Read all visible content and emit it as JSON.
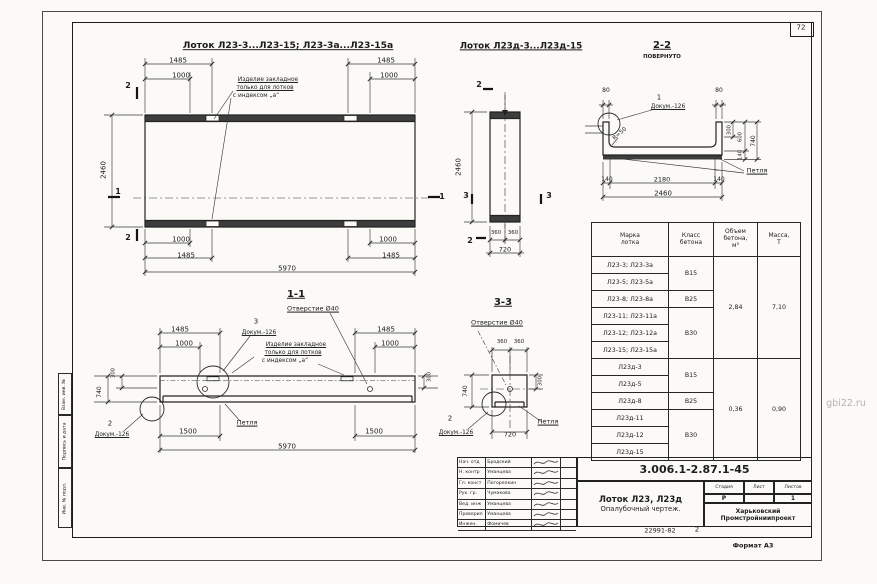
{
  "page": {
    "number": "72",
    "watermark": "gbi22.ru",
    "format": "Формат А3",
    "doc_code": "22991-82",
    "doc_code_extra": "2"
  },
  "side_stamps": [
    "Взам. инв. №",
    "Подпись и дата",
    "Инв. № подл."
  ],
  "title_block": {
    "code": "3.006.1-2.87.1-45",
    "product": "Лоток Л23, Л23д",
    "doc_type": "Опалубочный чертеж.",
    "stage_label": "Стадия",
    "sheet_label": "Лист",
    "sheets_label": "Листов",
    "stage": "Р",
    "sheet": "",
    "sheets": "1",
    "org_line1": "Харьковский",
    "org_line2": "Промстройниипроект"
  },
  "signatures": [
    {
      "role": "Нач. отд",
      "name": "Бродский"
    },
    {
      "role": "Н. контр",
      "name": "Уманцева"
    },
    {
      "role": "Гл. конст",
      "name": "Погорелкин"
    },
    {
      "role": "Рук. гр.",
      "name": "Чумакова"
    },
    {
      "role": "Вед. инж",
      "name": "Уманцева"
    },
    {
      "role": "Проверил",
      "name": "Уманцева"
    },
    {
      "role": "Инжен.",
      "name": "Фомичев"
    }
  ],
  "table": {
    "headers": [
      "Марка\nлотка",
      "Класс\nбетона",
      "Объем\nбетона,\nм³",
      "Масса,\nТ"
    ],
    "rows": [
      {
        "mark": "Л23-3; Л23-3а",
        "cls": "В15",
        "cls_span": 2,
        "vol": "2,84",
        "vol_span": 6,
        "mass": "7,10",
        "mass_span": 6
      },
      {
        "mark": "Л23-5; Л23-5а"
      },
      {
        "mark": "Л23-8; Л23-8а",
        "cls": "В25",
        "cls_span": 1
      },
      {
        "mark": "Л23-11; Л23-11а",
        "cls": "В30",
        "cls_span": 3
      },
      {
        "mark": "Л23-12; Л23-12а"
      },
      {
        "mark": "Л23-15; Л23-15а"
      },
      {
        "mark": "Л23д-3",
        "cls": "В15",
        "cls_span": 2,
        "vol": "0,36",
        "vol_span": 6,
        "mass": "0,90",
        "mass_span": 6
      },
      {
        "mark": "Л23д-5"
      },
      {
        "mark": "Л23д-8",
        "cls": "В25",
        "cls_span": 1
      },
      {
        "mark": "Л23д-11",
        "cls": "В30",
        "cls_span": 3
      },
      {
        "mark": "Л23д-12"
      },
      {
        "mark": "Л23д-15"
      }
    ]
  },
  "labels": [
    {
      "n": "view1-title",
      "t": "Лоток Л23-3...Л23-15; Л23-3а...Л23-15а",
      "x": 288,
      "y": 46,
      "s": 9.2,
      "u": 1,
      "b": 1
    },
    {
      "n": "view2-title",
      "t": "Лоток Л23д-3...Л23д-15",
      "x": 521,
      "y": 47,
      "s": 8.8,
      "u": 1,
      "b": 1
    },
    {
      "n": "section-2-2-title",
      "t": "2-2",
      "x": 662,
      "y": 46,
      "s": 10,
      "u": 1,
      "b": 1
    },
    {
      "n": "section-2-2-sub",
      "t": "ПОВЕРНУТО",
      "x": 662,
      "y": 58,
      "s": 5.4,
      "b": 1
    },
    {
      "n": "section-1-1-title",
      "t": "1-1",
      "x": 296,
      "y": 295,
      "s": 10,
      "u": 1,
      "b": 1
    },
    {
      "n": "section-3-3-title",
      "t": "3-3",
      "x": 503,
      "y": 303,
      "s": 10,
      "u": 1,
      "b": 1
    },
    {
      "n": "plan-dim",
      "t": "1485",
      "x": 178,
      "y": 61
    },
    {
      "n": "plan-dim",
      "t": "1000",
      "x": 181,
      "y": 76
    },
    {
      "n": "plan-dim",
      "t": "1485",
      "x": 386,
      "y": 61
    },
    {
      "n": "plan-dim",
      "t": "1000",
      "x": 389,
      "y": 76
    },
    {
      "n": "plan-dim",
      "t": "2460",
      "x": 104,
      "y": 170,
      "r": -90
    },
    {
      "n": "plan-dim",
      "t": "1000",
      "x": 181,
      "y": 240
    },
    {
      "n": "plan-dim",
      "t": "1485",
      "x": 186,
      "y": 256
    },
    {
      "n": "plan-dim",
      "t": "1000",
      "x": 388,
      "y": 240
    },
    {
      "n": "plan-dim",
      "t": "1485",
      "x": 391,
      "y": 256
    },
    {
      "n": "plan-dim",
      "t": "5970",
      "x": 287,
      "y": 269
    },
    {
      "n": "section-mark",
      "t": "2",
      "x": 128,
      "y": 86,
      "s": 8,
      "b": 1
    },
    {
      "n": "section-mark",
      "t": "2",
      "x": 128,
      "y": 238,
      "s": 8,
      "b": 1
    },
    {
      "n": "section-mark",
      "t": "1",
      "x": 118,
      "y": 192,
      "s": 8,
      "b": 1
    },
    {
      "n": "section-mark",
      "t": "1",
      "x": 442,
      "y": 197,
      "s": 8,
      "b": 1
    },
    {
      "n": "embed-note-line1",
      "t": "Изделие закладное",
      "x": 268,
      "y": 80,
      "s": 5.8,
      "u": 1
    },
    {
      "n": "embed-note-line2",
      "t": "только для лотков",
      "x": 265,
      "y": 88,
      "s": 5.8,
      "u": 1
    },
    {
      "n": "embed-note-line3",
      "t": "с индексом „а“",
      "x": 256,
      "y": 96,
      "s": 5.8
    },
    {
      "n": "mid-dim",
      "t": "2460",
      "x": 459,
      "y": 167,
      "r": -90
    },
    {
      "n": "mid-dim",
      "t": "360",
      "x": 496,
      "y": 234,
      "s": 5.4
    },
    {
      "n": "mid-dim",
      "t": "360",
      "x": 513,
      "y": 234,
      "s": 5.4
    },
    {
      "n": "mid-dim",
      "t": "720",
      "x": 505,
      "y": 250,
      "s": 6.5
    },
    {
      "n": "section-mark",
      "t": "2",
      "x": 479,
      "y": 85,
      "s": 8,
      "b": 1
    },
    {
      "n": "section-mark",
      "t": "2",
      "x": 470,
      "y": 241,
      "s": 8,
      "b": 1
    },
    {
      "n": "section-mark",
      "t": "3",
      "x": 466,
      "y": 196,
      "s": 8,
      "b": 1
    },
    {
      "n": "section-mark",
      "t": "3",
      "x": 549,
      "y": 196,
      "s": 8,
      "b": 1
    },
    {
      "n": "sec22-dim",
      "t": "80",
      "x": 606,
      "y": 91,
      "s": 6
    },
    {
      "n": "sec22-dim",
      "t": "80",
      "x": 719,
      "y": 91,
      "s": 6
    },
    {
      "n": "callout-number",
      "t": "1",
      "x": 659,
      "y": 98,
      "s": 7
    },
    {
      "n": "callout-doc",
      "t": "Докум.-126",
      "x": 668,
      "y": 107,
      "s": 5.8,
      "u": 1
    },
    {
      "n": "sec22-dim",
      "t": "R=50",
      "x": 620,
      "y": 134,
      "s": 5.8,
      "r": -42
    },
    {
      "n": "sec22-dim",
      "t": "300",
      "x": 730,
      "y": 130,
      "s": 5.2,
      "r": -90
    },
    {
      "n": "sec22-dim",
      "t": "600",
      "x": 741,
      "y": 137,
      "s": 5.2,
      "r": -90
    },
    {
      "n": "sec22-dim",
      "t": "140",
      "x": 741,
      "y": 155,
      "s": 5.2,
      "r": -90
    },
    {
      "n": "sec22-dim",
      "t": "740",
      "x": 754,
      "y": 141,
      "s": 6,
      "r": -90
    },
    {
      "n": "sec22-dim",
      "t": "140",
      "x": 607,
      "y": 180,
      "s": 6
    },
    {
      "n": "sec22-dim",
      "t": "2180",
      "x": 662,
      "y": 180,
      "s": 6.5
    },
    {
      "n": "sec22-dim",
      "t": "140",
      "x": 719,
      "y": 180,
      "s": 6
    },
    {
      "n": "sec22-dim",
      "t": "2460",
      "x": 663,
      "y": 194,
      "s": 7
    },
    {
      "n": "loop-label",
      "t": "Петля",
      "x": 757,
      "y": 171,
      "s": 6.5,
      "u": 1
    },
    {
      "n": "hole-label",
      "t": "Отверстие Ø40",
      "x": 313,
      "y": 309,
      "s": 6.5,
      "u": 1
    },
    {
      "n": "callout-number",
      "t": "3",
      "x": 256,
      "y": 322,
      "s": 7
    },
    {
      "n": "callout-doc",
      "t": "Докум.-126",
      "x": 259,
      "y": 333,
      "s": 5.8,
      "u": 1
    },
    {
      "n": "embed-note-line1",
      "t": "Изделие закладное",
      "x": 296,
      "y": 345,
      "s": 5.8,
      "u": 1
    },
    {
      "n": "embed-note-line2",
      "t": "только для лотков",
      "x": 293,
      "y": 353,
      "s": 5.8,
      "u": 1
    },
    {
      "n": "embed-note-line3",
      "t": "с индексом „а“",
      "x": 285,
      "y": 361,
      "s": 5.8
    },
    {
      "n": "sec11-dim",
      "t": "1485",
      "x": 180,
      "y": 330
    },
    {
      "n": "sec11-dim",
      "t": "1000",
      "x": 184,
      "y": 344
    },
    {
      "n": "sec11-dim",
      "t": "1485",
      "x": 386,
      "y": 330
    },
    {
      "n": "sec11-dim",
      "t": "1000",
      "x": 390,
      "y": 344
    },
    {
      "n": "sec11-dim",
      "t": "740",
      "x": 100,
      "y": 392,
      "s": 6,
      "r": -90
    },
    {
      "n": "sec11-dim",
      "t": "300",
      "x": 114,
      "y": 373,
      "s": 5.2,
      "r": -90
    },
    {
      "n": "sec11-dim",
      "t": "300",
      "x": 430,
      "y": 377,
      "s": 5.2,
      "r": -90
    },
    {
      "n": "callout-number",
      "t": "2",
      "x": 110,
      "y": 424,
      "s": 7
    },
    {
      "n": "callout-doc",
      "t": "Докум.-126",
      "x": 112,
      "y": 435,
      "s": 5.8,
      "u": 1
    },
    {
      "n": "loop-label",
      "t": "Петля",
      "x": 247,
      "y": 423,
      "s": 6.5,
      "u": 1
    },
    {
      "n": "sec11-dim",
      "t": "1500",
      "x": 188,
      "y": 432
    },
    {
      "n": "sec11-dim",
      "t": "1500",
      "x": 374,
      "y": 432
    },
    {
      "n": "sec11-dim",
      "t": "5970",
      "x": 287,
      "y": 447
    },
    {
      "n": "hole-label",
      "t": "Отверстие Ø40",
      "x": 497,
      "y": 323,
      "s": 6.5,
      "u": 1
    },
    {
      "n": "sec33-dim",
      "t": "360",
      "x": 502,
      "y": 343,
      "s": 5.4
    },
    {
      "n": "sec33-dim",
      "t": "360",
      "x": 519,
      "y": 343,
      "s": 5.4
    },
    {
      "n": "sec33-dim",
      "t": "740",
      "x": 466,
      "y": 391,
      "s": 6,
      "r": -90
    },
    {
      "n": "sec33-dim",
      "t": "300",
      "x": 541,
      "y": 381,
      "s": 5.2,
      "r": -90
    },
    {
      "n": "sec33-dim",
      "t": "720",
      "x": 510,
      "y": 435,
      "s": 6.5
    },
    {
      "n": "callout-number",
      "t": "2",
      "x": 450,
      "y": 419,
      "s": 7
    },
    {
      "n": "callout-doc",
      "t": "Докум.-126",
      "x": 456,
      "y": 433,
      "s": 5.8,
      "u": 1
    },
    {
      "n": "loop-label",
      "t": "Петля",
      "x": 548,
      "y": 422,
      "s": 6.5,
      "u": 1
    }
  ]
}
